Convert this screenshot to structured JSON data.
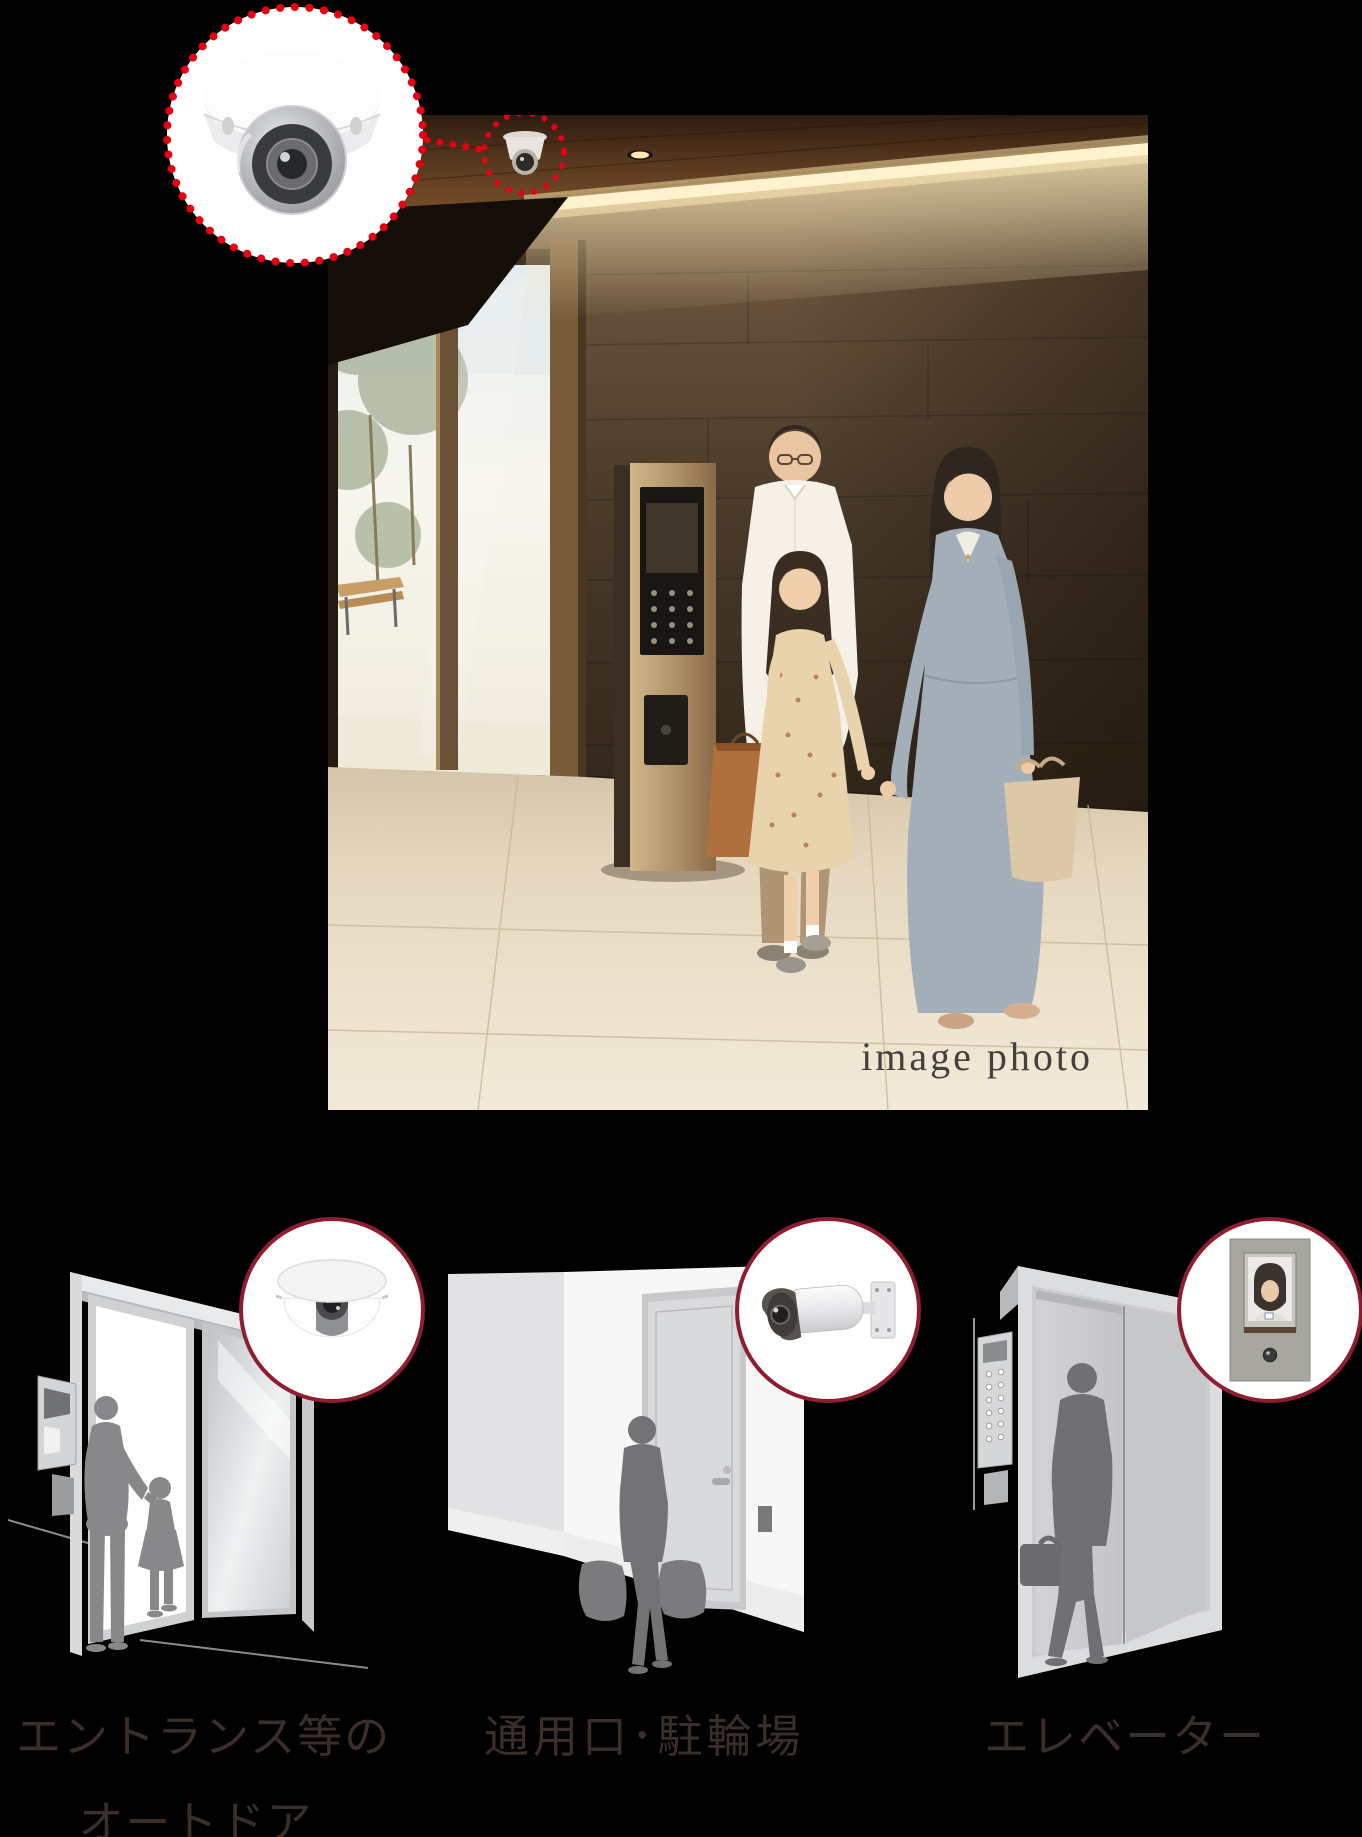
{
  "page": {
    "background": "#000000"
  },
  "photo": {
    "caption": "image photo"
  },
  "hero_callout": {
    "icon": "dome-security-camera",
    "ring_color": "#e60012"
  },
  "features": [
    {
      "id": "entrance-auto-door",
      "label_lines": [
        "エントランス等の",
        "オートドア"
      ],
      "callout_icon": "dome-camera"
    },
    {
      "id": "service-entrance-bicycle-parking",
      "label_lines": [
        "通用口･駐輪場"
      ],
      "callout_icon": "bullet-camera"
    },
    {
      "id": "elevator",
      "label_lines": [
        "エレベーター"
      ],
      "callout_icon": "elevator-monitor-camera"
    }
  ],
  "colors": {
    "accent_dotted_red": "#e60012",
    "callout_ring": "#8e1d30",
    "label_text": "#3a2e29",
    "caption_text": "#45403c"
  }
}
